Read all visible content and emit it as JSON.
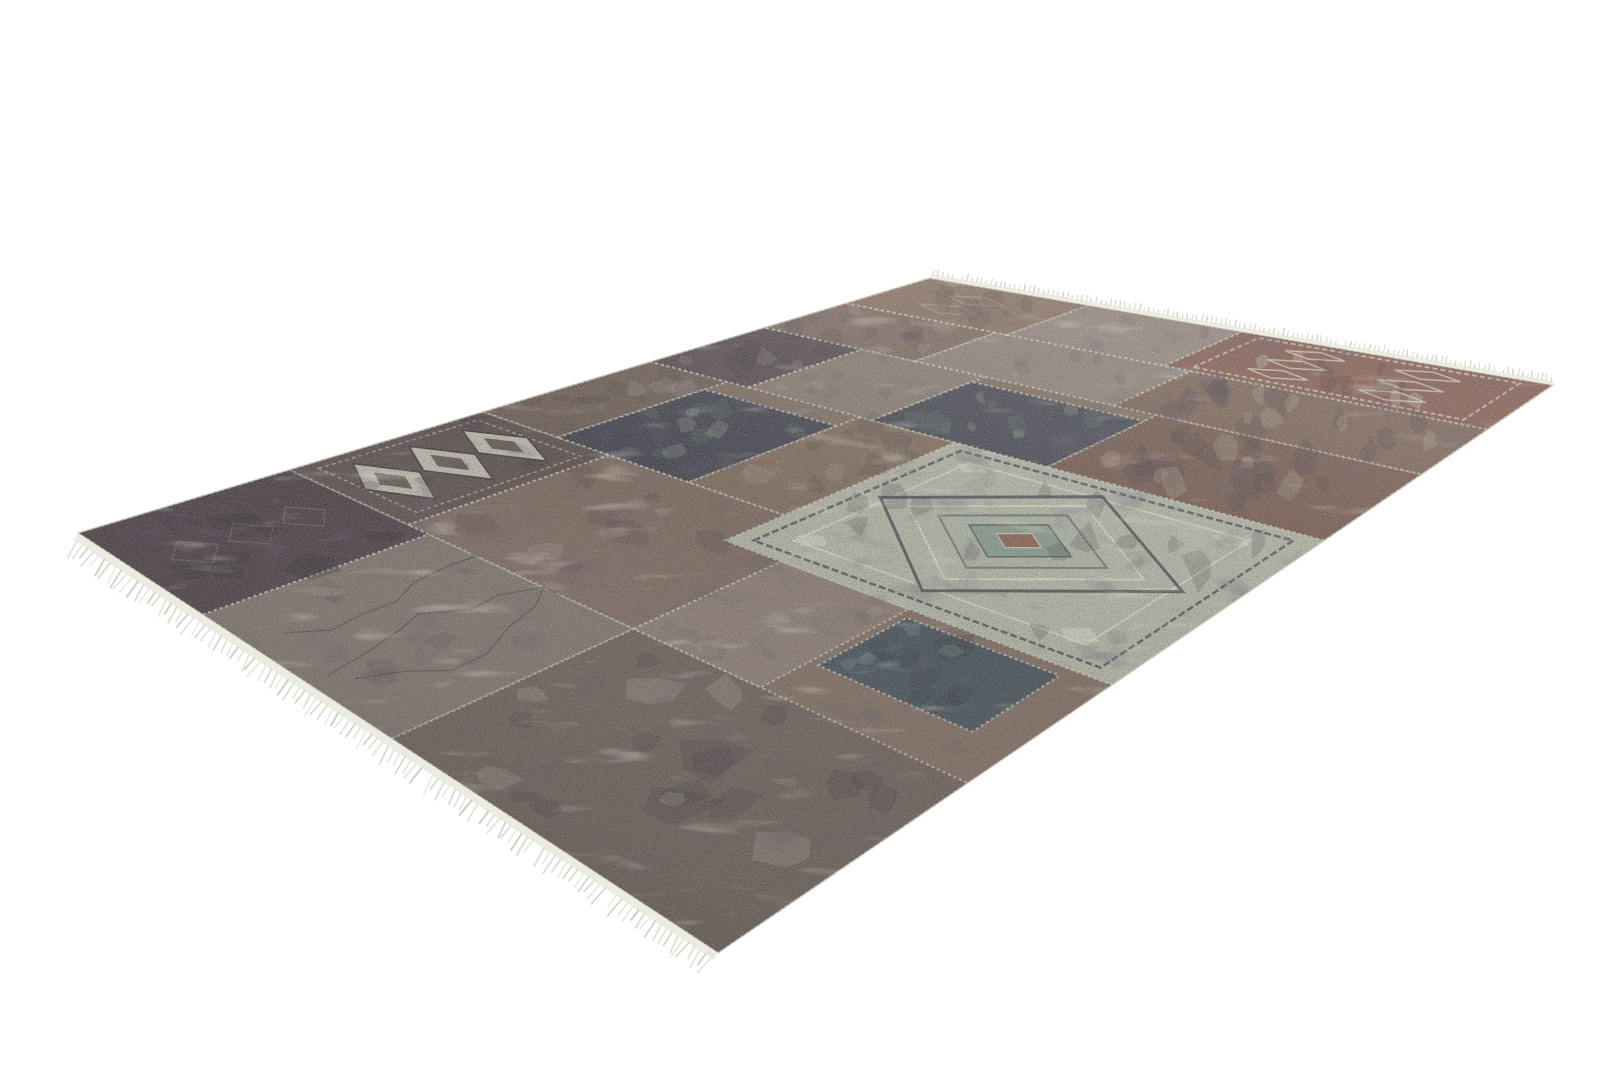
{
  "scene": {
    "background": "#ffffff",
    "subject": "patchwork-area-rug-product-photo"
  },
  "rug": {
    "corners": {
      "left": [
        78,
        533
      ],
      "top": [
        930,
        278
      ],
      "right": [
        1553,
        385
      ],
      "bottom": [
        718,
        953
      ]
    },
    "base_color": "#7f6d60",
    "seam_color": "#cbcfbf",
    "edge_line_color": "#c9c7ba",
    "deco": {
      "dark": "#4e4e58",
      "cream": "#d6d8c6",
      "teal": "#7e968a",
      "rust": "#8a5f4c",
      "ink": "#3d3a42",
      "inkdark": "#352c28",
      "sage": "#c6cbb9",
      "sagefill": "#a9b2a2",
      "speckle": "#5c7468"
    },
    "fringe": {
      "long_edge": {
        "band_color": "#ebebe0",
        "strand_colors": [
          "#dedfd3",
          "#cfd0c5",
          "#e7e7dc"
        ],
        "band_width": 8,
        "strand_len": [
          13,
          23
        ],
        "stroke_width": [
          1.2,
          2.2
        ],
        "count": 115
      },
      "short_edge": {
        "band_color": "#edece0",
        "strand_colors": [
          "#dcdbce",
          "#d3d2c6"
        ],
        "band_width": 4,
        "strand_len": [
          4,
          8
        ],
        "stroke_width": [
          0.9,
          1.5
        ],
        "count": 130
      }
    },
    "patches": [
      {
        "id": "left-corner-ornate",
        "u": [
          0,
          0.17
        ],
        "v": [
          0,
          0.3
        ],
        "fill": "#4a4146",
        "type": "ornate-dark"
      },
      {
        "id": "left-mid-taupe",
        "u": [
          0,
          0.17
        ],
        "v": [
          0.3,
          0.63
        ],
        "fill": "#7f756c",
        "type": "scribble"
      },
      {
        "id": "left-lower-brown",
        "u": [
          0,
          0.17
        ],
        "v": [
          0.63,
          1
        ],
        "fill": "#6d6158",
        "type": "mottled-heavy"
      },
      {
        "id": "chain-medallion",
        "u": [
          0.17,
          0.36
        ],
        "v": [
          0,
          0.26
        ],
        "fill": "#5e524e",
        "type": "medallion-chain"
      },
      {
        "id": "mid-left-brown",
        "u": [
          0.17,
          0.36
        ],
        "v": [
          0.26,
          0.63
        ],
        "fill": "#7d6a5f",
        "type": "mottled"
      },
      {
        "id": "lower-left-taupe",
        "u": [
          0.17,
          0.3
        ],
        "v": [
          0.63,
          0.79
        ],
        "fill": "#8b7d71",
        "type": "plain"
      },
      {
        "id": "teal-square-near",
        "u": [
          0.21,
          0.29
        ],
        "v": [
          0.8,
          0.96
        ],
        "fill": "#47525a",
        "type": "mottled-teal"
      },
      {
        "id": "far-center-brown",
        "u": [
          0.36,
          0.56
        ],
        "v": [
          0,
          0.16
        ],
        "fill": "#6f6056",
        "type": "mottled"
      },
      {
        "id": "navy-square-far",
        "u": [
          0.36,
          0.53
        ],
        "v": [
          0.16,
          0.4
        ],
        "fill": "#42444d",
        "type": "dark-speckle"
      },
      {
        "id": "center-brown-strip",
        "u": [
          0.36,
          0.56
        ],
        "v": [
          0.4,
          0.55
        ],
        "fill": "#806c5b",
        "type": "mottled"
      },
      {
        "id": "cream-medallion",
        "u": [
          0.3,
          0.56
        ],
        "v": [
          0.55,
          1
        ],
        "fill": "#b2b5a4",
        "type": "medallion"
      },
      {
        "id": "apex-dark",
        "u": [
          0.56,
          0.72
        ],
        "v": [
          0,
          0.2
        ],
        "fill": "#564c4e",
        "type": "mottled"
      },
      {
        "id": "center-right-taupe",
        "u": [
          0.56,
          0.72
        ],
        "v": [
          0.2,
          0.42
        ],
        "fill": "#897b6f",
        "type": "plain"
      },
      {
        "id": "slate-square-right",
        "u": [
          0.56,
          0.7
        ],
        "v": [
          0.42,
          0.68
        ],
        "fill": "#44474f",
        "type": "dark-speckle"
      },
      {
        "id": "right-ornate-brown",
        "u": [
          0.56,
          0.72
        ],
        "v": [
          0.68,
          1
        ],
        "fill": "#74584b",
        "type": "mottled-heavy"
      },
      {
        "id": "apex-brown",
        "u": [
          0.72,
          0.85
        ],
        "v": [
          0,
          0.3
        ],
        "fill": "#7e6a5e",
        "type": "mottled"
      },
      {
        "id": "right-taupe",
        "u": [
          0.72,
          0.85
        ],
        "v": [
          0.3,
          0.62
        ],
        "fill": "#8d8177",
        "type": "plain"
      },
      {
        "id": "right-brown-mottle",
        "u": [
          0.72,
          0.85
        ],
        "v": [
          0.62,
          1
        ],
        "fill": "#7a6151",
        "type": "mottled-heavy"
      },
      {
        "id": "top-corner-brown",
        "u": [
          0.85,
          1
        ],
        "v": [
          0,
          0.32
        ],
        "fill": "#88705f",
        "type": "ornate-faint"
      },
      {
        "id": "right-edge-taupe",
        "u": [
          0.85,
          1
        ],
        "v": [
          0.32,
          0.58
        ],
        "fill": "#92857a",
        "type": "plain"
      },
      {
        "id": "right-corner-rust",
        "u": [
          0.85,
          1
        ],
        "v": [
          0.58,
          1
        ],
        "fill": "#82584a",
        "type": "ornate-rust"
      }
    ]
  }
}
